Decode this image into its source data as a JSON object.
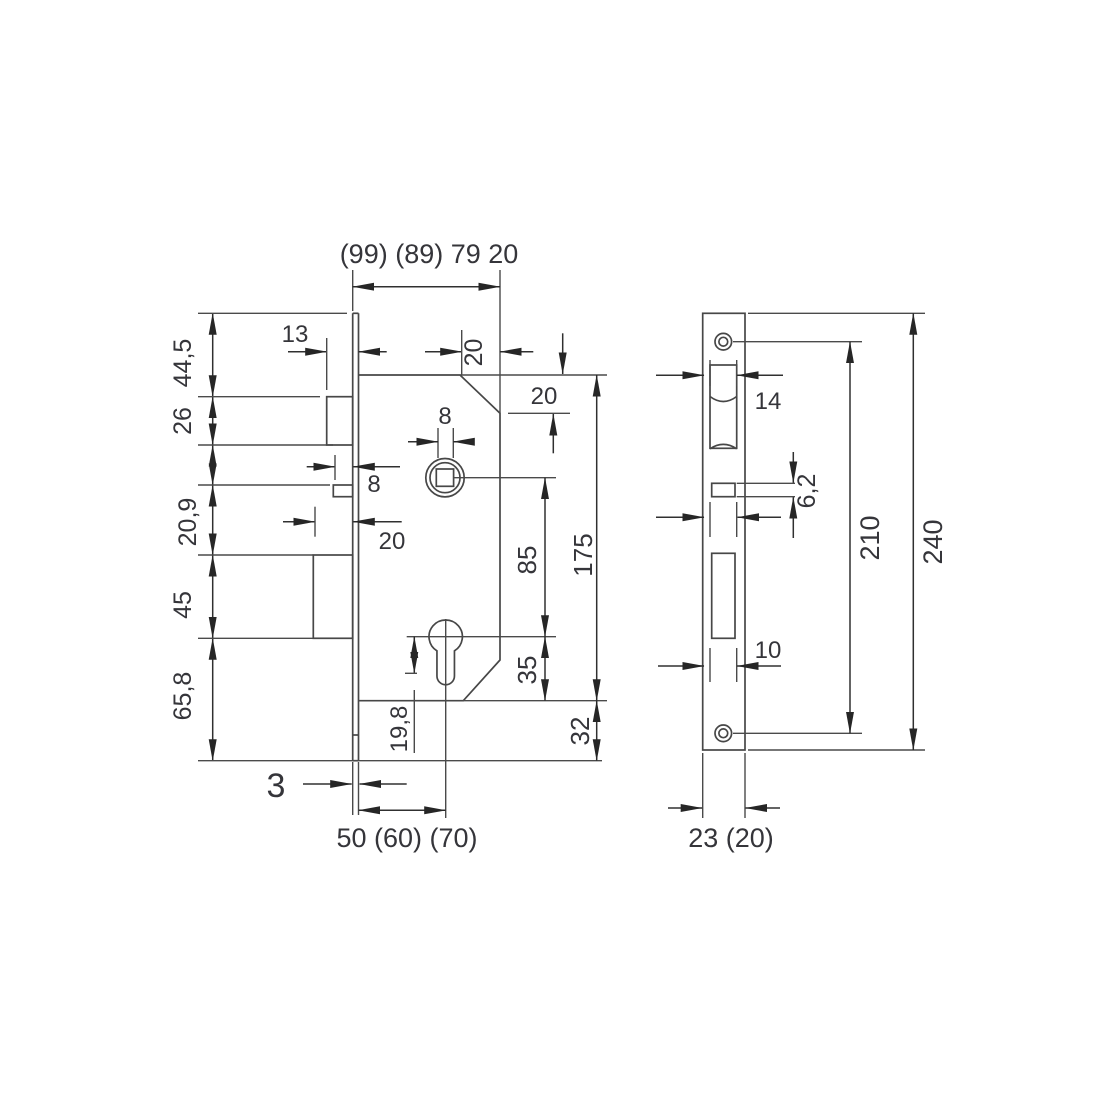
{
  "side_view": {
    "overall_width": "(99) (89) 79 20",
    "edge_to_case": "20",
    "latch_throw": "13",
    "top_edge_to_chamfer": "20",
    "follower_square": "8",
    "follower_nub": "8",
    "deadbolt_throw": "20",
    "case_height": "175",
    "follower_to_cylinder": "85",
    "cylinder_to_case_bottom": "35",
    "case_bottom_to_plate_end": "32",
    "cylinder_offset": "19,8",
    "heights": [
      "44,5",
      "26",
      "20,9",
      "45",
      "65,8"
    ],
    "plate_thickness": "3",
    "backset": "50 (60) (70)"
  },
  "front_view": {
    "latch_cutout_width": "14",
    "follower_slot_height": "6,2",
    "screw_centers": "210",
    "plate_length": "240",
    "deadbolt_slot_width": "10",
    "plate_width": "23 (20)"
  }
}
